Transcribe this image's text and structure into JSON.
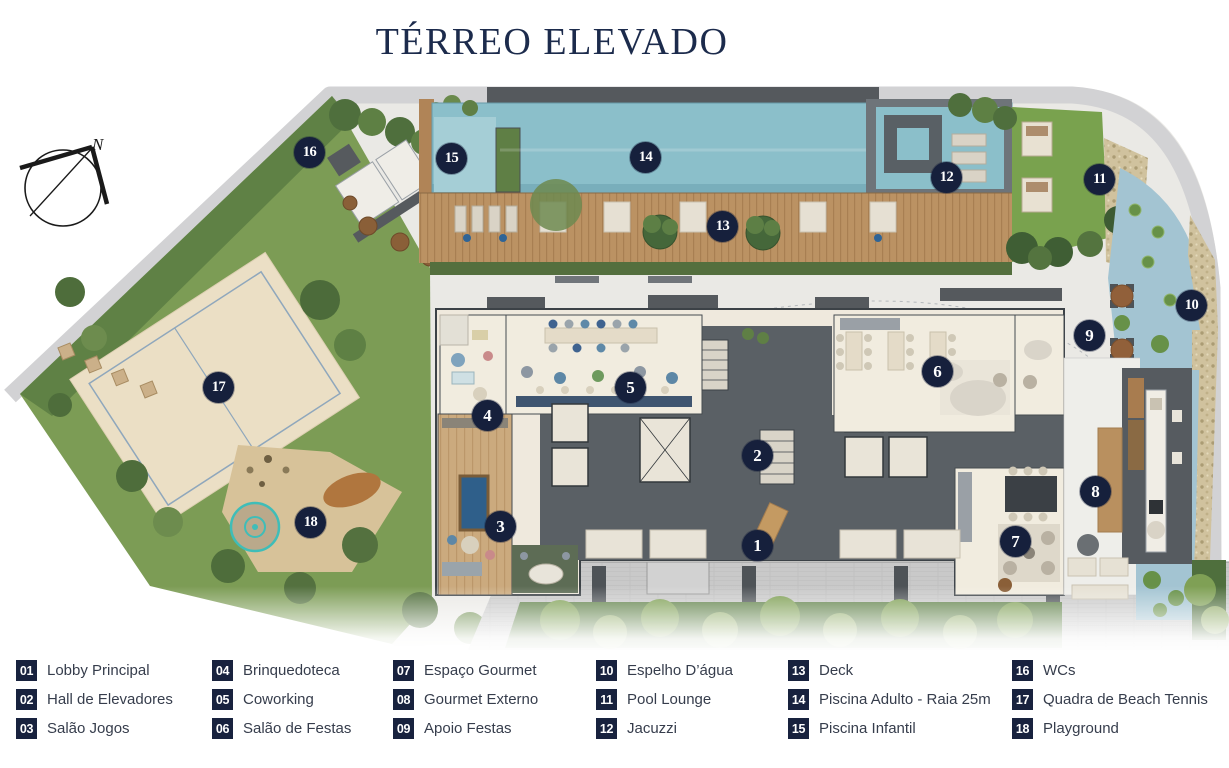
{
  "title": "TÉRREO ELEVADO",
  "compass": {
    "label": "N"
  },
  "colors": {
    "accent_navy": "#18223e",
    "title_navy": "#1c2b4c",
    "pool_teal": "#8bbfca",
    "deck_wood": "#bb9263",
    "lawn_green": "#79a24e",
    "sand_court": "#ebdfc5",
    "building_charcoal": "#5a6065",
    "water_mirror": "#a3c4d2"
  },
  "legend": {
    "items": [
      {
        "num": "01",
        "label": "Lobby Principal"
      },
      {
        "num": "02",
        "label": "Hall de Elevadores"
      },
      {
        "num": "03",
        "label": "Salão Jogos"
      },
      {
        "num": "04",
        "label": "Brinquedoteca"
      },
      {
        "num": "05",
        "label": "Coworking"
      },
      {
        "num": "06",
        "label": "Salão de Festas"
      },
      {
        "num": "07",
        "label": "Espaço Gourmet"
      },
      {
        "num": "08",
        "label": "Gourmet Externo"
      },
      {
        "num": "09",
        "label": "Apoio Festas"
      },
      {
        "num": "10",
        "label": "Espelho D’água"
      },
      {
        "num": "11",
        "label": "Pool Lounge"
      },
      {
        "num": "12",
        "label": "Jacuzzi"
      },
      {
        "num": "13",
        "label": "Deck"
      },
      {
        "num": "14",
        "label": "Piscina Adulto - Raia 25m"
      },
      {
        "num": "15",
        "label": "Piscina Infantil"
      },
      {
        "num": "16",
        "label": "WCs"
      },
      {
        "num": "17",
        "label": "Quadra de Beach Tennis"
      },
      {
        "num": "18",
        "label": "Playground"
      }
    ]
  },
  "plan": {
    "markers": [
      {
        "num": "1"
      },
      {
        "num": "2"
      },
      {
        "num": "3"
      },
      {
        "num": "4"
      },
      {
        "num": "5"
      },
      {
        "num": "6"
      },
      {
        "num": "7"
      },
      {
        "num": "8"
      },
      {
        "num": "9"
      },
      {
        "num": "10"
      },
      {
        "num": "11"
      },
      {
        "num": "12"
      },
      {
        "num": "13"
      },
      {
        "num": "14"
      },
      {
        "num": "15"
      },
      {
        "num": "16"
      },
      {
        "num": "17"
      },
      {
        "num": "18"
      }
    ]
  }
}
